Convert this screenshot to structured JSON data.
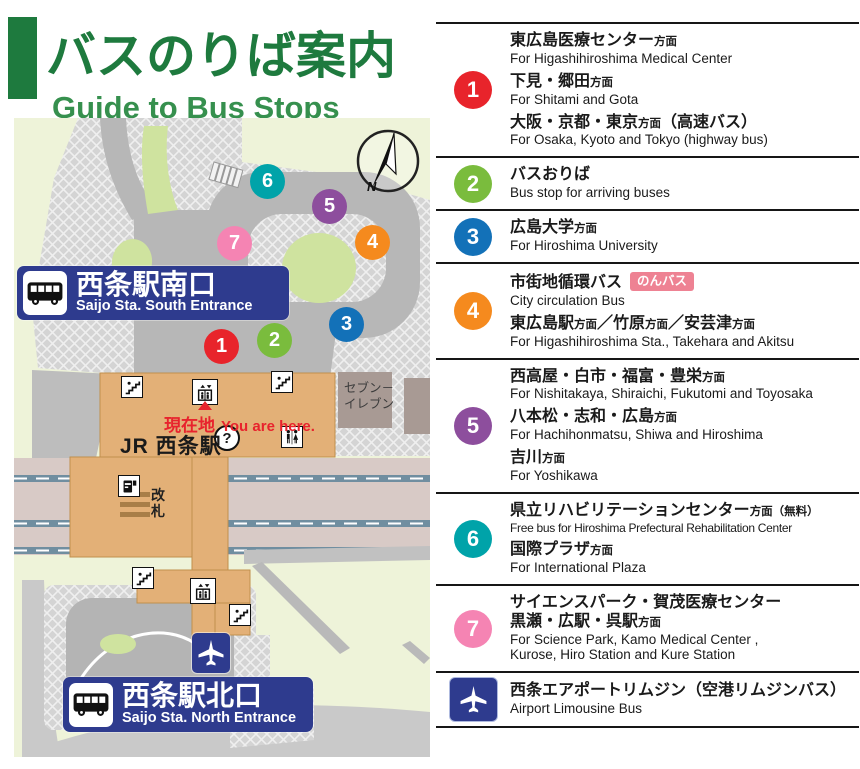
{
  "title": {
    "jp": "バスのりば案内",
    "en": "Guide to Bus Stops"
  },
  "colors": {
    "title_green": "#1e7a3e",
    "title_green_light": "#36904e",
    "badge_navy": "#2e3b8e",
    "nonbus_pink": "#ee8293",
    "you_are_here_red": "#e8232d"
  },
  "map": {
    "south_entrance": {
      "jp": "西条駅南口",
      "en": "Saijo Sta. South Entrance"
    },
    "north_entrance": {
      "jp": "西条駅北口",
      "en": "Saijo Sta. North Entrance"
    },
    "station_label": "JR 西条駅",
    "you_are_here": {
      "jp": "現在地",
      "en": "You are here."
    },
    "seven_eleven": {
      "line1": "セブン－",
      "line2": "イレブン"
    },
    "ticket_gate": "改札",
    "info_mark": "?",
    "compass_label": "N",
    "markers": [
      {
        "number": "1",
        "color": "#e8242b"
      },
      {
        "number": "2",
        "color": "#7abc3d"
      },
      {
        "number": "3",
        "color": "#1371b8"
      },
      {
        "number": "4",
        "color": "#f58a1e"
      },
      {
        "number": "5",
        "color": "#8d4e9d"
      },
      {
        "number": "6",
        "color": "#00a3a9"
      },
      {
        "number": "7",
        "color": "#f584b3"
      }
    ]
  },
  "legend": {
    "entries": [
      {
        "icon": {
          "type": "number",
          "label": "1",
          "color": "#e8242b"
        },
        "groups": [
          {
            "jp_lines": [
              [
                {
                  "t": "東広島医療センター"
                },
                {
                  "t": "方面",
                  "small": true
                }
              ]
            ],
            "en_lines": [
              "For Higashihiroshima Medical Center"
            ]
          },
          {
            "jp_lines": [
              [
                {
                  "t": "下見・郷田"
                },
                {
                  "t": "方面",
                  "small": true
                }
              ]
            ],
            "en_lines": [
              "For Shitami and Gota"
            ]
          },
          {
            "jp_lines": [
              [
                {
                  "t": "大阪・京都・東京"
                },
                {
                  "t": "方面",
                  "small": true
                },
                {
                  "t": "（高速バス）"
                }
              ]
            ],
            "en_lines": [
              "For Osaka, Kyoto and Tokyo (highway bus)"
            ]
          }
        ]
      },
      {
        "icon": {
          "type": "number",
          "label": "2",
          "color": "#7abc3d"
        },
        "groups": [
          {
            "jp_lines": [
              [
                {
                  "t": "バスおりば"
                }
              ]
            ],
            "en_lines": [
              "Bus stop for arriving buses"
            ]
          }
        ]
      },
      {
        "icon": {
          "type": "number",
          "label": "3",
          "color": "#1371b8"
        },
        "groups": [
          {
            "jp_lines": [
              [
                {
                  "t": "広島大学"
                },
                {
                  "t": "方面",
                  "small": true
                }
              ]
            ],
            "en_lines": [
              "For Hiroshima University"
            ]
          }
        ]
      },
      {
        "icon": {
          "type": "number",
          "label": "4",
          "color": "#f58a1e"
        },
        "groups": [
          {
            "jp_lines": [
              [
                {
                  "t": "市街地循環バス"
                }
              ]
            ],
            "badge": "のんバス",
            "en_lines": [
              "City circulation Bus"
            ]
          },
          {
            "jp_lines": [
              [
                {
                  "t": "東広島駅"
                },
                {
                  "t": "方面",
                  "small": true
                },
                {
                  "t": "／竹原"
                },
                {
                  "t": "方面",
                  "small": true
                },
                {
                  "t": "／安芸津"
                },
                {
                  "t": "方面",
                  "small": true
                }
              ]
            ],
            "en_lines": [
              "For Higashihiroshima Sta., Takehara and Akitsu"
            ]
          }
        ]
      },
      {
        "icon": {
          "type": "number",
          "label": "5",
          "color": "#8d4e9d"
        },
        "groups": [
          {
            "jp_lines": [
              [
                {
                  "t": "西高屋・白市・福富・豊栄"
                },
                {
                  "t": "方面",
                  "small": true
                }
              ]
            ],
            "en_lines": [
              "For Nishitakaya, Shiraichi, Fukutomi and Toyosaka"
            ]
          },
          {
            "jp_lines": [
              [
                {
                  "t": "八本松・志和・広島"
                },
                {
                  "t": "方面",
                  "small": true
                }
              ]
            ],
            "en_lines": [
              "For Hachihonmatsu, Shiwa and Hiroshima"
            ]
          },
          {
            "jp_lines": [
              [
                {
                  "t": "吉川"
                },
                {
                  "t": "方面",
                  "small": true
                }
              ]
            ],
            "en_lines": [
              "For Yoshikawa"
            ]
          }
        ]
      },
      {
        "icon": {
          "type": "number",
          "label": "6",
          "color": "#00a3a9"
        },
        "groups": [
          {
            "jp_lines": [
              [
                {
                  "t": "県立リハビリテーションセンター"
                },
                {
                  "t": "方面（無料）",
                  "small": true
                }
              ]
            ],
            "en_lines": [
              "Free bus for Hiroshima Prefectural Rehabilitation Center"
            ],
            "en_tight": true
          },
          {
            "jp_lines": [
              [
                {
                  "t": "国際プラザ"
                },
                {
                  "t": "方面",
                  "small": true
                }
              ]
            ],
            "en_lines": [
              "For International Plaza"
            ]
          }
        ]
      },
      {
        "icon": {
          "type": "number",
          "label": "7",
          "color": "#f584b3"
        },
        "groups": [
          {
            "jp_lines": [
              [
                {
                  "t": "サイエンスパーク・賀茂医療センター"
                }
              ],
              [
                {
                  "t": "黒瀬・広駅・呉駅"
                },
                {
                  "t": "方面",
                  "small": true
                }
              ]
            ],
            "en_lines": [
              "For Science Park, Kamo Medical Center ,",
              "Kurose, Hiro Station and Kure Station"
            ]
          }
        ]
      },
      {
        "icon": {
          "type": "airplane"
        },
        "groups": [
          {
            "jp_lines": [
              [
                {
                  "t": "西条エアポートリムジン（空港リムジンバス）"
                }
              ]
            ],
            "en_lines": [
              "Airport Limousine Bus"
            ]
          }
        ]
      }
    ]
  }
}
